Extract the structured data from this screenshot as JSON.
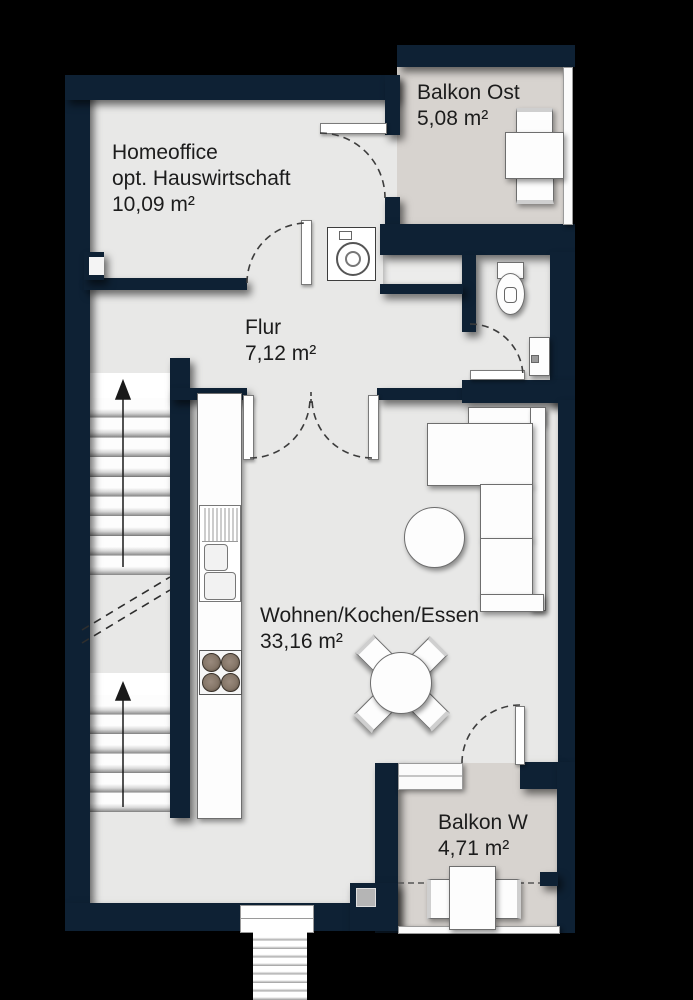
{
  "floorplan": {
    "background_color": "#000000",
    "wall_color": "#0e2134",
    "floor_color": "#e8e8e7",
    "balcony_floor_color": "#d7d3cf",
    "text_color": "#1c1c1c",
    "rooms": [
      {
        "name": "Homeoffice",
        "name2": "opt. Hauswirtschaft",
        "area": "10,09 m²"
      },
      {
        "name": "Balkon Ost",
        "area": "5,08 m²"
      },
      {
        "name": "Flur",
        "area": "7,12 m²"
      },
      {
        "name": "Wohnen/Kochen/Essen",
        "area": "33,16 m²"
      },
      {
        "name": "Balkon W",
        "area": "4,71 m²"
      }
    ]
  }
}
